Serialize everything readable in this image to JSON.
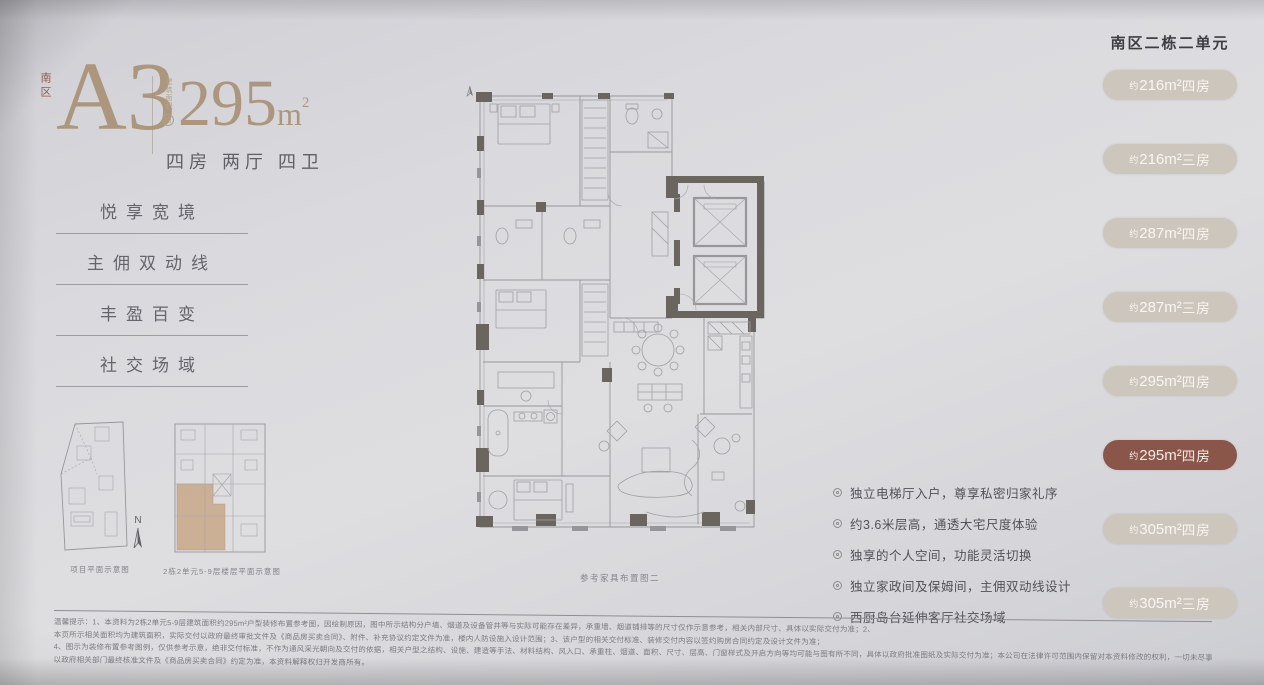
{
  "colors": {
    "background": "#d9d9dd",
    "accent_tan": "#ac977e",
    "zone_red": "#96584c",
    "pill_normal": "#cdc6bd",
    "pill_active": "#8a564a",
    "pill_text": "#f8f5f1",
    "body_text": "#515157"
  },
  "unit": {
    "zone_label": "南区",
    "code": "A3",
    "area_prefix": "建筑面积",
    "area_approx": "约",
    "area_value": "295",
    "area_unit": "m",
    "area_sup": "2",
    "layout": "四房 两厅 四卫"
  },
  "features": [
    "悦享宽境",
    "主佣双动线",
    "丰盈百变",
    "社交场域"
  ],
  "mini_plans": {
    "site_caption": "项目平面示意图",
    "key_caption": "2栋2单元5-9层楼层平面示意图",
    "compass_label": "N"
  },
  "floorplan": {
    "caption": "参考家具布置图二"
  },
  "highlights": [
    "独立电梯厅入户，尊享私密归家礼序",
    "约3.6米层高，通透大宅尺度体验",
    "独享的个人空间，功能灵活切换",
    "独立家政间及保姆间，主佣双动线设计",
    "西厨岛台延伸客厅社交场域"
  ],
  "unit_list": {
    "header": "南区二栋二单元",
    "items": [
      {
        "approx": "约",
        "size": "216m²",
        "rooms": "四房",
        "active": false
      },
      {
        "approx": "约",
        "size": "216m²",
        "rooms": "三房",
        "active": false
      },
      {
        "approx": "约",
        "size": "287m²",
        "rooms": "四房",
        "active": false
      },
      {
        "approx": "约",
        "size": "287m²",
        "rooms": "三房",
        "active": false
      },
      {
        "approx": "约",
        "size": "295m²",
        "rooms": "四房",
        "active": false
      },
      {
        "approx": "约",
        "size": "295m²",
        "rooms": "四房",
        "active": true
      },
      {
        "approx": "约",
        "size": "305m²",
        "rooms": "四房",
        "active": false
      },
      {
        "approx": "约",
        "size": "305m²",
        "rooms": "三房",
        "active": false
      }
    ]
  },
  "disclaimer": {
    "lines": [
      "温馨提示：1、本资料为2栋2单元5-9层建筑面积约295m²户型装修布置参考图，因绘制原因，图中所示结构分户墙、烟道及设备管井等与实际可能存在差异，承重墙、烟道铺排等的尺寸仅作示意参考，相关内部尺寸、具体以实际交付为准；2、",
      "本页所示相关面积均为建筑面积，实际交付以政府最终审批文件及《商品房买卖合同》、附件、补充协议约定文件为准，楼内人防设施入设计范围；3、该户型的相关交付标准、装修交付内容以签约购房合同约定及设计文件为准；",
      "4、图示为装修布置参考图例，仅供参考示意，绝非交付标准，不作为通风采光朝向及交付的依据，相关户型之结构、设施、建造等手法、材料结构、风入口、承重柱、烟道、面积、尺寸、层高、门窗样式及开启方向等均可能与图有所不同，具体以政府批准图纸及实际交付为准；本公司在法律许可范围内保留对本资料修改的权利，一切未尽事宜",
      "以政府相关部门最终核准文件及《商品房买卖合同》约定为准，本资料解释权归开发商所有。"
    ]
  }
}
